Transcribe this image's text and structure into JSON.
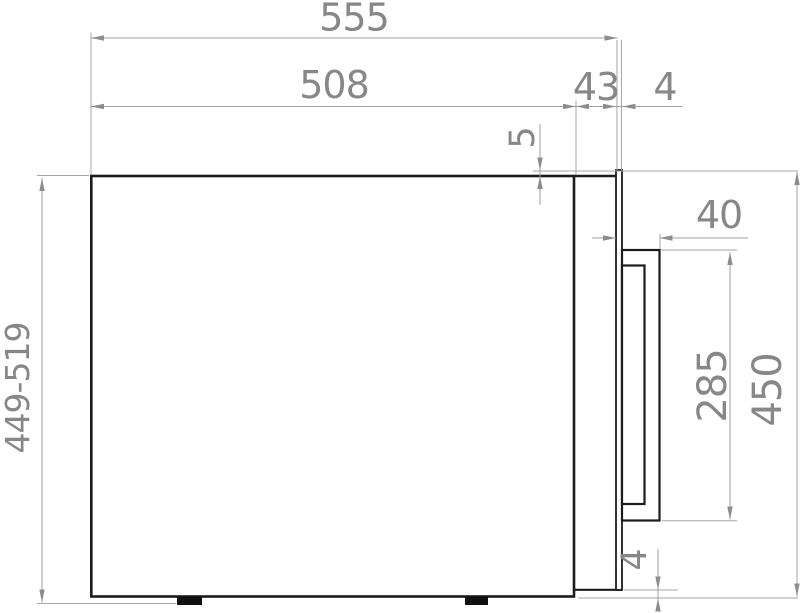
{
  "drawing": {
    "colors": {
      "outline": "#1b1b1b",
      "dimension_lines": "#a0a0a0",
      "dimension_text": "#878787",
      "background": "#ffffff"
    },
    "dims": {
      "total_depth": "555",
      "body_depth": "508",
      "front_frame_depth": "43",
      "door_thickness": "4",
      "door_top_overlap": "5",
      "handle_depth": "40",
      "handle_height": "285",
      "front_height": "450",
      "height_range": "449-519",
      "door_bottom_gap": "4"
    }
  }
}
